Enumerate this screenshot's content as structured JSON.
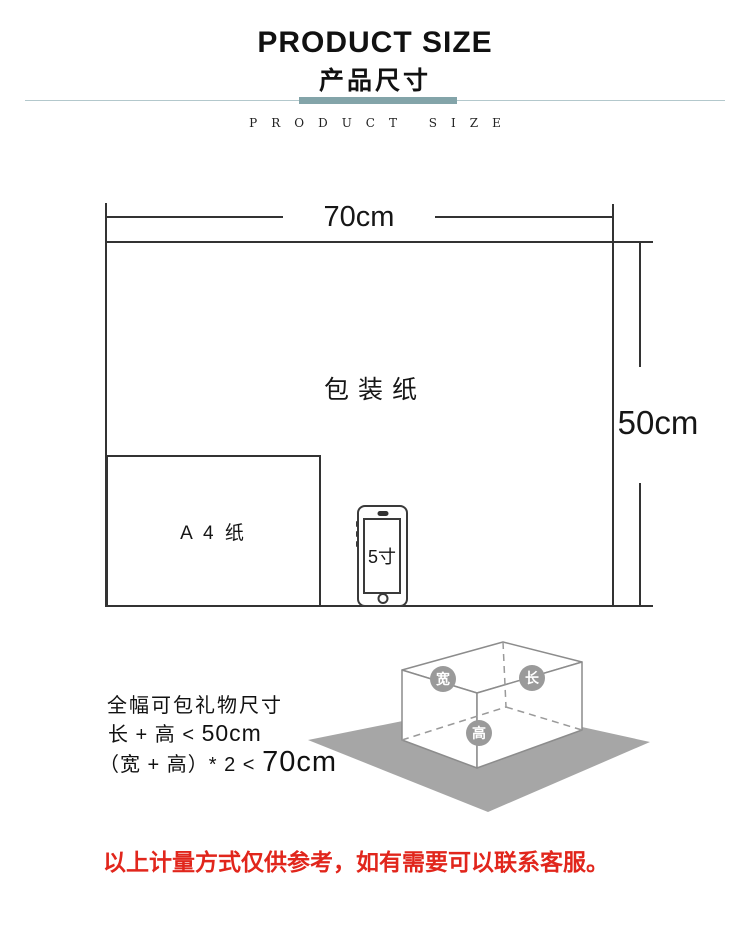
{
  "header": {
    "title": "PRODUCT SIZE",
    "subtitle": "产品尺寸",
    "tagline": "PRODUCT SIZE",
    "accent_color": "#83a4a9",
    "thin_line_color": "#b3c8cc"
  },
  "diagram": {
    "width_dimension": "70cm",
    "height_dimension": "50cm",
    "paper_label": "包装纸",
    "a4_label": "A 4 纸",
    "phone_label": "5寸"
  },
  "gift_size": {
    "title": "全幅可包礼物尺寸",
    "rule1_prefix": "长 + 高 < ",
    "rule1_value": "50cm",
    "rule2_prefix": "（宽 + 高）* 2 < ",
    "rule2_value": "70cm"
  },
  "box_illustration": {
    "width_badge": "宽",
    "length_badge": "长",
    "height_badge": "高",
    "sheet_color": "#a6a6a6",
    "badge_color": "#9a9a9a",
    "edge_color": "#8c8c8c"
  },
  "footer": {
    "note": "以上计量方式仅供参考，如有需要可以联系客服。",
    "color": "#e1261c"
  }
}
